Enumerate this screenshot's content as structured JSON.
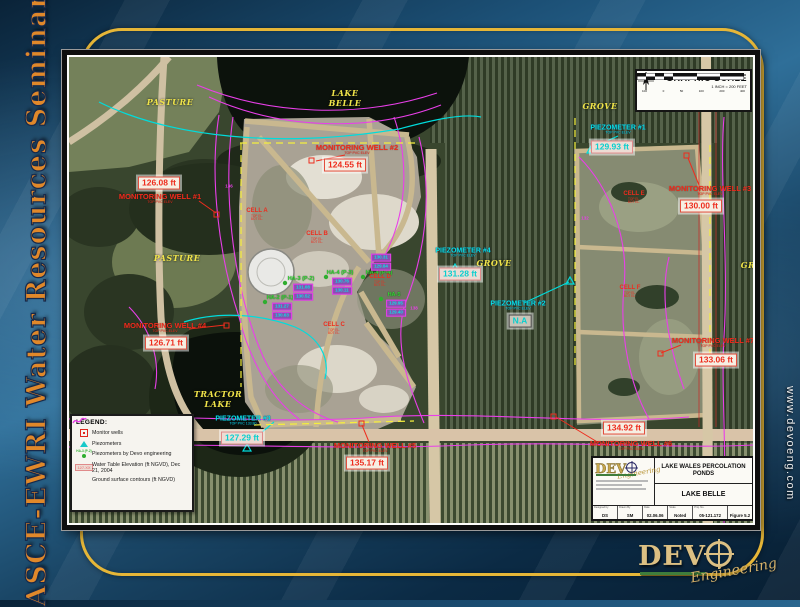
{
  "slide": {
    "left_banner": "ASCE-EWRI Water Resources Seminar",
    "right_banner": "www.devoeng.com",
    "logo": {
      "word": "DEV",
      "script": "Engineering"
    }
  },
  "map": {
    "scale_box": {
      "north_label": "NORTH",
      "title": "GRAPHIC SCALE",
      "subtitle": "1 INCH = 200 FEET",
      "ticks": [
        "100",
        "0",
        "50",
        "100",
        "200",
        "400"
      ]
    },
    "area_labels": [
      {
        "text": "PASTURE"
      },
      {
        "text": "LAKE"
      },
      {
        "text": "BELLE"
      },
      {
        "text": "GROVE"
      },
      {
        "text": "GROVE"
      },
      {
        "text": "PASTURE"
      },
      {
        "text": "TRACTOR"
      },
      {
        "text": "LAKE"
      },
      {
        "text": "GR"
      }
    ],
    "wells": [
      {
        "name": "MONITORING WELL #1",
        "sub": "TOP PVC ELEV",
        "value": "126.08 ft"
      },
      {
        "name": "MONITORING WELL #2",
        "sub": "TOP PVC ELEV",
        "value": "124.55 ft"
      },
      {
        "name": "MONITORING WELL #3",
        "sub": "TOP PVC ELEV",
        "value": "130.00 ft"
      },
      {
        "name": "MONITORING WELL #4",
        "sub": "TOP PVC ELEV",
        "value": "126.71 ft"
      },
      {
        "name": "MONITORING WELL #5",
        "sub": "TOP PVC ELEV",
        "value": "135.17 ft"
      },
      {
        "name": "MONITORING WELL #6",
        "sub": "TOP PVC ELEV",
        "value": "134.92 ft"
      },
      {
        "name": "MONITORING WELL #7",
        "sub": "TOP PVC ELEV",
        "value": "133.06 ft"
      }
    ],
    "piezometers": [
      {
        "name": "PIEZOMETER #1",
        "sub": "TOP PVC ELEV",
        "value": "129.93 ft"
      },
      {
        "name": "PIEZOMETER #2",
        "sub": "TOP PVC ELEV",
        "value": "N.A"
      },
      {
        "name": "PIEZOMETER #3",
        "sub": "TOP PVC 133.80",
        "value": "127.29 ft"
      },
      {
        "name": "PIEZOMETER #4",
        "sub": "TOP PVC ELEV",
        "value": "131.28 ft"
      }
    ],
    "cells": [
      {
        "name": "CELL A",
        "sub1": "TOP EL.",
        "sub2": "BOT EL."
      },
      {
        "name": "CELL B",
        "sub1": "TOP EL.",
        "sub2": "BOT EL."
      },
      {
        "name": "CELL C",
        "sub1": "TOP EL.",
        "sub2": "BOT EL."
      },
      {
        "name": "CELL D",
        "sub1": "TOP EL.",
        "sub2": "BOT EL."
      },
      {
        "name": "CELL E",
        "sub1": "TOP EL.",
        "sub2": "BOT EL."
      },
      {
        "name": "CELL F",
        "sub1": "TOP EL.",
        "sub2": "BOT EL."
      }
    ],
    "borings": [
      {
        "label": "HA-2 (P-1)",
        "v1": "131.27",
        "v2": "130.63"
      },
      {
        "label": "HA-3 (P-2)",
        "v1": "131.08",
        "v2": "130.52"
      },
      {
        "label": "HA-4 (P-3)",
        "v1": "130.76",
        "v2": "130.11"
      },
      {
        "label": "HA-4 (P-4)",
        "v1": "130.31",
        "v2": "129.84"
      },
      {
        "label": "HA-5",
        "v1": "129.95",
        "v2": "129.40"
      }
    ],
    "contour_labels": [
      {
        "text": "136"
      },
      {
        "text": "138"
      },
      {
        "text": "132"
      }
    ],
    "legend": {
      "title": "LEGEND:",
      "well_item": "Monitor wells",
      "piezo_item": "Piezometers",
      "devo_item": "Piezometers by Devo engineering",
      "devo_icon_label": "HA-3 (P-2)",
      "wt_icon_label": "127.XX",
      "wt_item": "Water Table Elevation (ft NGVD), Dec 21, 2004",
      "contour_item": "Ground surface contours (ft NGVD)"
    },
    "titleblock": {
      "company": "DEV",
      "script": "Engineering",
      "project": "LAKE WALES PERCOLATION PONDS",
      "drawing": "LAKE BELLE",
      "fields": [
        {
          "label": "Designed by",
          "value": "DS"
        },
        {
          "label": "Drawn By",
          "value": "SM"
        },
        {
          "label": "Date",
          "value": "02.06.06"
        },
        {
          "label": "Scale",
          "value": "Noted"
        },
        {
          "label": "Proj. No.",
          "value": "05-121.172"
        },
        {
          "label": "",
          "value": "Figure 5.2"
        }
      ]
    },
    "colors": {
      "accent_gold": "#e6b637",
      "label_red": "#ee2c1d",
      "label_cyan": "#0ae6e6",
      "label_yellow": "#f0e44a",
      "contour_magenta": "#e93fe9",
      "boring_green": "#37d437"
    }
  }
}
